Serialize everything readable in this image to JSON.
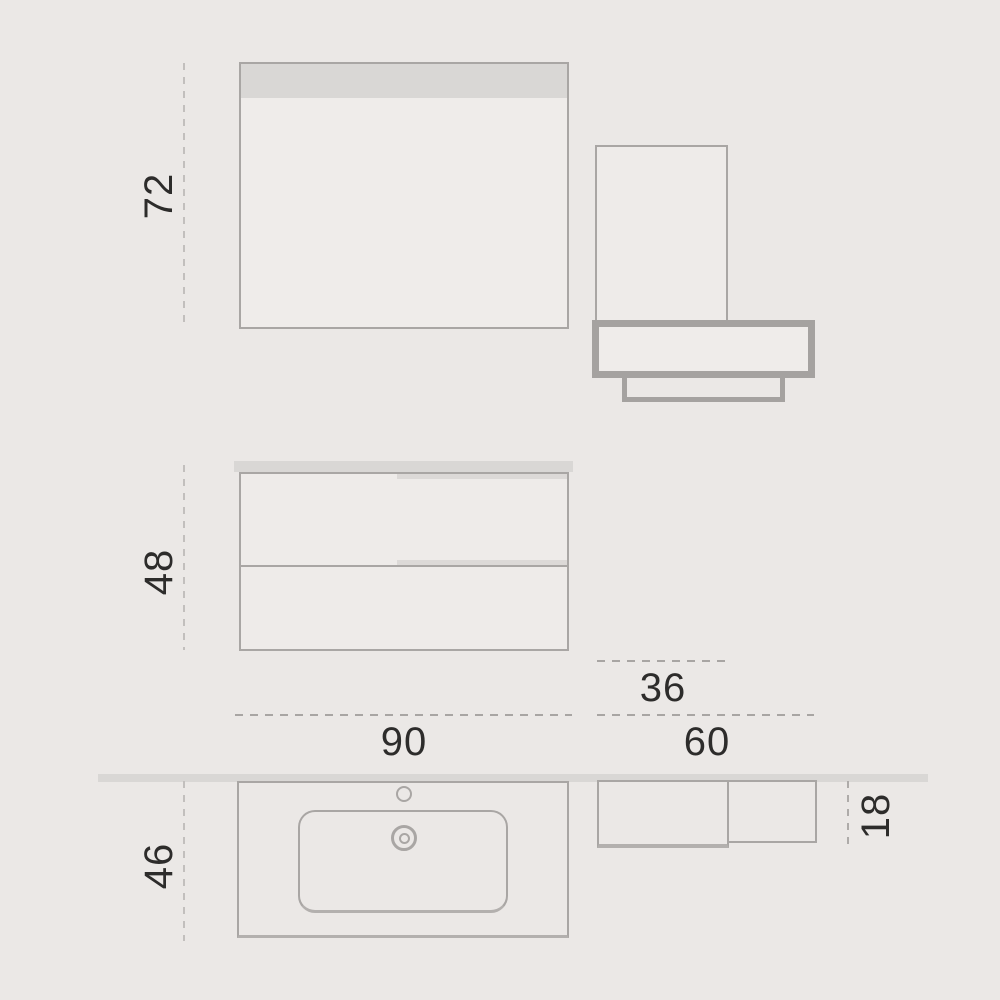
{
  "labels": {
    "mirror_height": "72",
    "vanity_height": "48",
    "vanity_depth": "46",
    "vanity_width": "90",
    "column_width": "36",
    "shelf_width": "60",
    "shelf_depth": "18"
  },
  "colors": {
    "background": "#ebe8e6",
    "line": "#a9a6a4",
    "thick_frame": "#a5a2a0",
    "panel_fill": "#efecea",
    "band_fill": "#d9d7d5",
    "dash_light": "#c2bfbd",
    "dash_dark": "#a8a5a3",
    "text": "#2d2c2b"
  }
}
